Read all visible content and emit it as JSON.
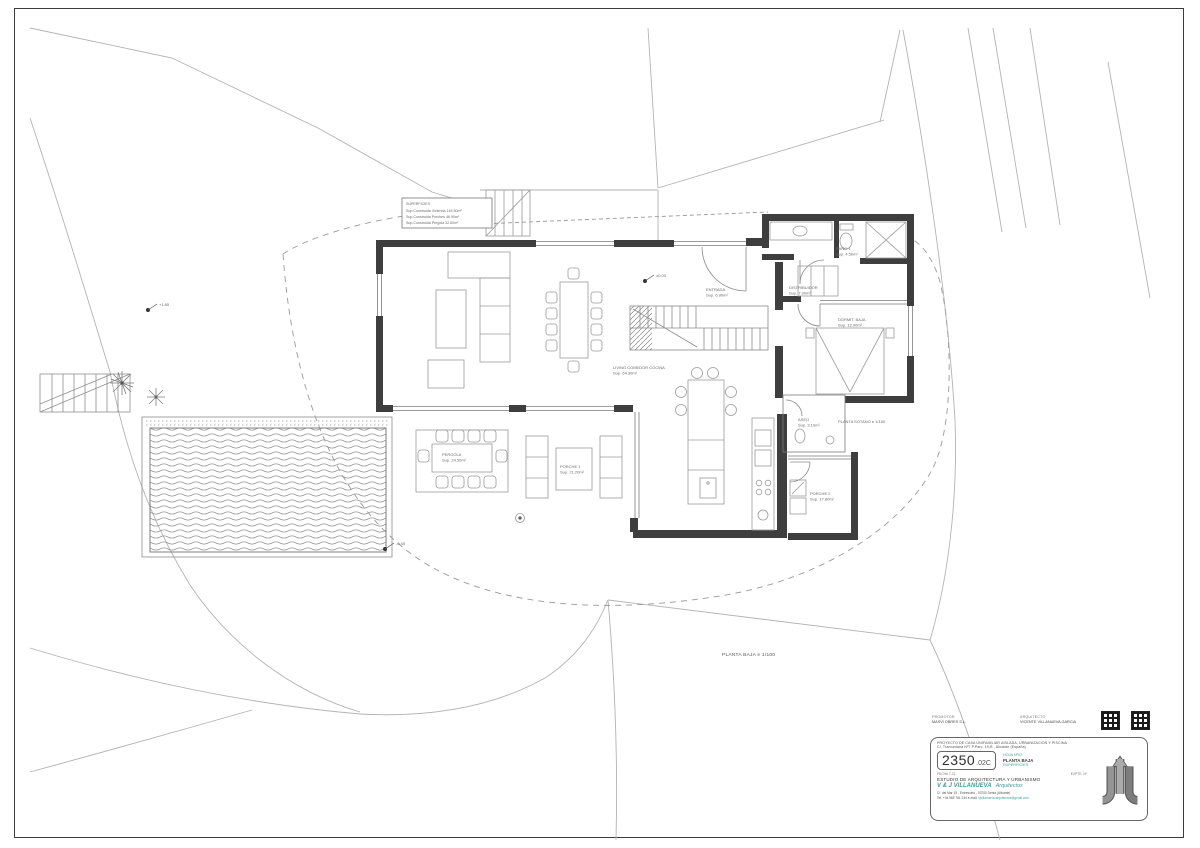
{
  "colors": {
    "accent": "#3f9e98",
    "wall": "#3e3e3e",
    "line": "#9b9b9b"
  },
  "plan": {
    "ground_title": "PLANTA BAJA e 1/100",
    "sotano_title": "PLANTA SOTANO e 1/100",
    "legend": {
      "title": "SUPERFICIES",
      "line1": "Sup.Construida Vivienda 145.50m²",
      "line2": "Sup.Construida Porches 46.90m²",
      "line3": "Sup.Construida Pergola 32.60m²"
    },
    "rooms": {
      "living": {
        "name": "LIVING COMEDOR COCINA",
        "area": "Sup. 64.30m²"
      },
      "entrada": {
        "name": "ENTRADA",
        "area": "Sup. 6.90m²"
      },
      "distribuidor": {
        "name": "DISTRIBUIDOR",
        "area": "Sup. 7.90m²"
      },
      "bano": {
        "name": "BAÑO 1",
        "area": "Sup. 4.50m²"
      },
      "dormitorio": {
        "name": "DORMIT. BAJA",
        "area": "Sup. 12.90m²"
      },
      "aseo": {
        "name": "ASEO",
        "area": "Sup. 3.10m²"
      },
      "pergola": {
        "name": "PERGOLA",
        "area": "Sup. 24.50m²"
      },
      "porche1": {
        "name": "PORCHE 1",
        "area": "Sup. 21.20m²"
      },
      "porche2": {
        "name": "PORCHE 2",
        "area": "Sup. 17.80m²"
      }
    },
    "levels": {
      "terrain": "+1.85",
      "entry": "±0.00",
      "pool": "-0.45"
    }
  },
  "title_block": {
    "promoter_label": "PROMOTOR",
    "promoter_name": "MASVI OBRES S.L.",
    "architect_label": "ARQUITECTO",
    "architect_name": "VICENTE VILLANUEVA GARCIA",
    "project_line1": "PROYECTO DE CASA UNIFAMILIAR AISLADA, URBANIZACION Y PISCINA",
    "project_line2": "C/. Tramuntana Nº7 P.Parc. 19-B , Alicante (España)",
    "job_number": "2350",
    "job_suffix": ".02C",
    "sheet_label": "HOJA Nº02",
    "sheet_name": "PLANTA BAJA",
    "sheet_subject": "SUPERFICIES",
    "date_label": "FECHA 7.22",
    "expte_label": "EXPTE. Nº",
    "studio_line": "ESTUDIO DE ARQUITECTURA Y URBANISMO",
    "firm_name": "V & J VILLANUEVA",
    "firm_suffix": "Arquitectos",
    "address": "C/. del Mar 15 - Entresuelo - 03700 Denia (Alicante)",
    "contact": "Tel. +34 965 781 234   e-mail:",
    "email": "vjvillanueva.arquitectos@gmail.com"
  }
}
